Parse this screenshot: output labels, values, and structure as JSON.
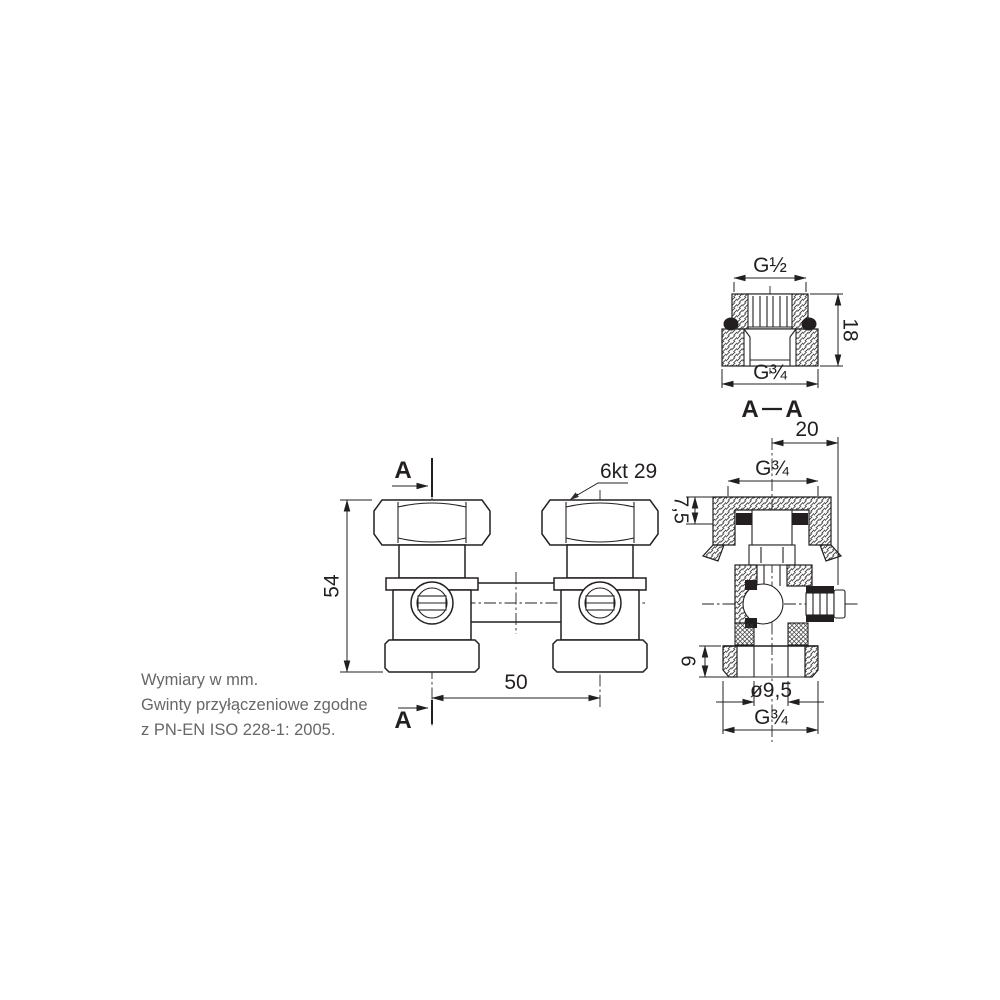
{
  "notes": {
    "line1": "Wymiary w mm.",
    "line2": "Gwinty przyłączeniowe zgodne",
    "line3": "z PN-EN ISO 228-1: 2005."
  },
  "front_view": {
    "section_letter_top": "A",
    "section_letter_bottom": "A",
    "dim_height_mm": "54",
    "dim_spacing_mm": "50",
    "hex_label": "6kt 29"
  },
  "adapter_view": {
    "thread_top": "G½",
    "height_mm": "18",
    "thread_bottom": "G¾"
  },
  "section_view": {
    "title_a_left": "A",
    "title_a_right": "A",
    "offset_mm": "20",
    "thread_top": "G¾",
    "flange_depth_mm": "7,5",
    "tail_height_mm": "9",
    "bore_mm": "ø9,5",
    "thread_bottom": "G¾"
  },
  "colors": {
    "line": "#231f20",
    "note_text": "#66676a",
    "background": "#ffffff"
  }
}
